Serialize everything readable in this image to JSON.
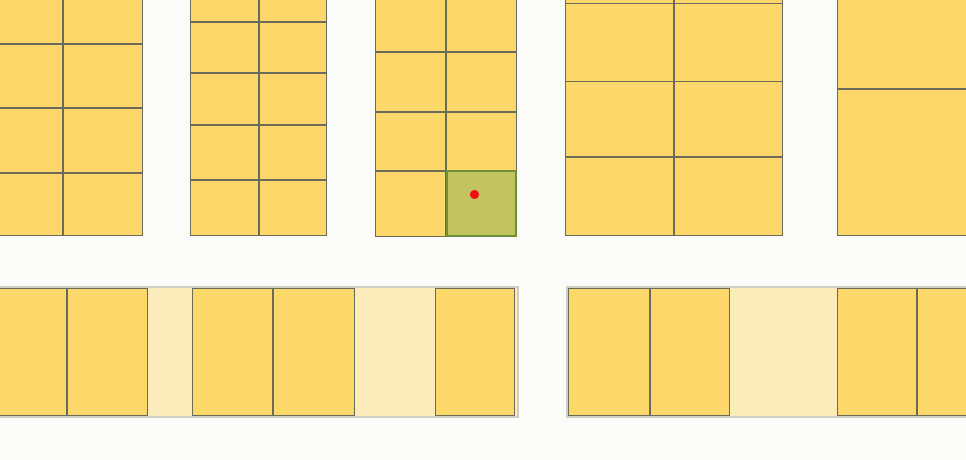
{
  "map": {
    "viewport": {
      "width": 966,
      "height": 460
    },
    "colors": {
      "background": "#fcfcfb",
      "parcel_fill": "#fdd76a",
      "parcel_border": "#6b6b5a",
      "underlay_fill": "#fcecbb",
      "underlay_border": "#cfcfc4",
      "selected_fill": "#c2c55f",
      "selected_border": "#6f8f3a",
      "marker_color": "#ee1111"
    },
    "blocks": [
      {
        "x": -10,
        "y": -20,
        "w": 153,
        "h": 256,
        "cols": [
          73,
          80
        ],
        "rows": [
          64,
          64,
          65,
          63
        ]
      },
      {
        "x": 190,
        "y": -30,
        "w": 137,
        "h": 266,
        "cols": [
          69,
          68
        ],
        "rows": [
          52,
          51,
          52,
          55,
          56
        ]
      },
      {
        "x": 375,
        "y": -8,
        "w": 142,
        "h": 245,
        "cols": [
          71,
          71
        ],
        "rows": [
          60,
          60,
          59,
          66
        ]
      },
      {
        "x": 565,
        "y": -40,
        "w": 218,
        "h": 276,
        "cols": [
          109,
          109
        ],
        "rows": [
          43,
          78,
          76,
          79
        ]
      },
      {
        "x": 837,
        "y": -40,
        "w": 141,
        "h": 276,
        "cols": [
          141
        ],
        "rows": [
          129,
          147
        ]
      }
    ],
    "underlays": [
      {
        "x": -10,
        "y": 286,
        "w": 529,
        "h": 132
      },
      {
        "x": 566,
        "y": 286,
        "w": 414,
        "h": 132
      }
    ],
    "strip_parcels": [
      {
        "x": -10,
        "y": 288,
        "w": 77,
        "h": 128
      },
      {
        "x": 67,
        "y": 288,
        "w": 81,
        "h": 128
      },
      {
        "x": 192,
        "y": 288,
        "w": 81,
        "h": 128
      },
      {
        "x": 273,
        "y": 288,
        "w": 82,
        "h": 128
      },
      {
        "x": 435,
        "y": 288,
        "w": 80,
        "h": 128
      },
      {
        "x": 568,
        "y": 288,
        "w": 82,
        "h": 128
      },
      {
        "x": 650,
        "y": 288,
        "w": 80,
        "h": 128
      },
      {
        "x": 837,
        "y": 288,
        "w": 80,
        "h": 128
      },
      {
        "x": 917,
        "y": 288,
        "w": 63,
        "h": 128
      }
    ],
    "selected_parcel": {
      "x": 446,
      "y": 170,
      "w": 71,
      "h": 67
    },
    "marker": {
      "cx": 474.5,
      "cy": 194.5,
      "r": 4.5
    }
  }
}
